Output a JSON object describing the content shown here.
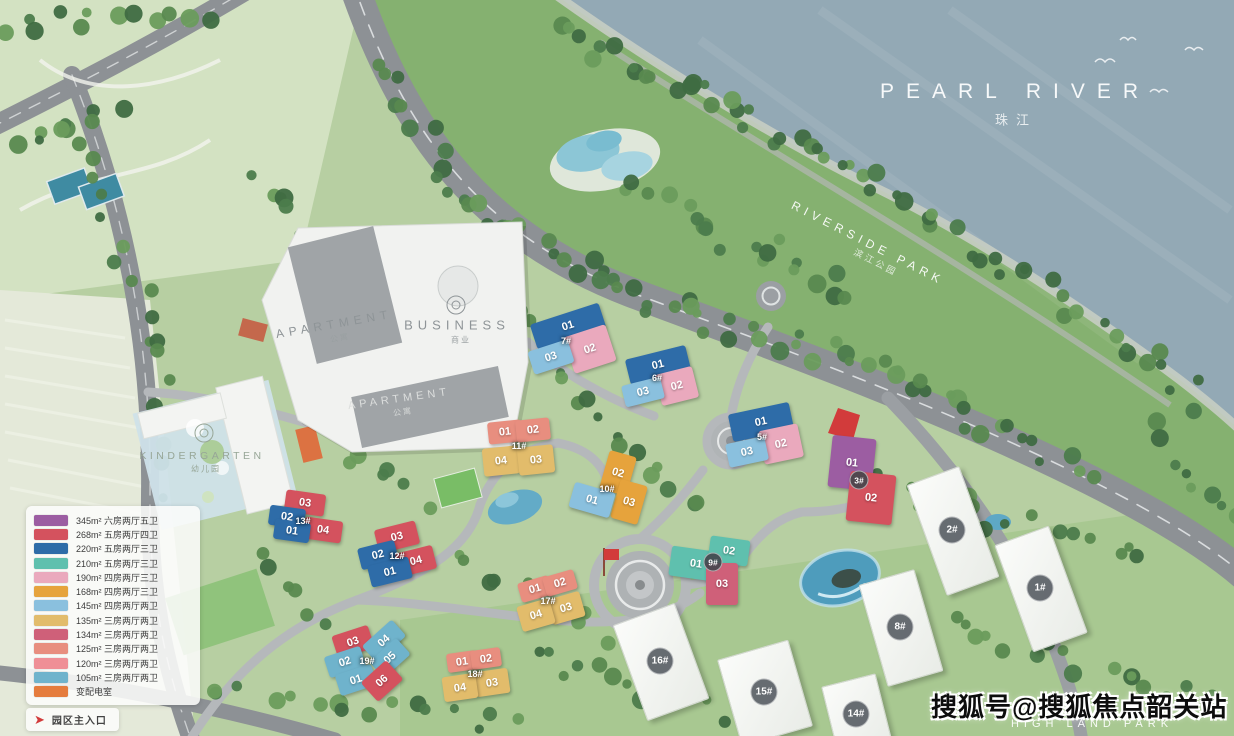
{
  "watermark": "搜狐号@搜狐焦点韶关站",
  "labels": {
    "river_en": "PEARL RIVER",
    "river_zh": "珠江",
    "riverside_en": "RIVERSIDE PARK",
    "riverside_zh": "滨江公园",
    "highland_en": "HIGH LAND PARK",
    "apartment_upper_en": "APARTMENT",
    "apartment_upper_zh": "公寓",
    "business_en": "BUSINESS",
    "business_zh": "商业",
    "apartment_lower_en": "APARTMENT",
    "apartment_lower_zh": "公寓",
    "kindergarten_en": "KINDERGARTEN",
    "kindergarten_zh": "幼儿园"
  },
  "legend": {
    "rows": [
      {
        "color": "#9c5da2",
        "area": "345m²",
        "desc": "六房两厅五卫"
      },
      {
        "color": "#d4525e",
        "area": "268m²",
        "desc": "五房两厅四卫"
      },
      {
        "color": "#2e6ca8",
        "area": "220m²",
        "desc": "五房两厅三卫"
      },
      {
        "color": "#5fc0ae",
        "area": "210m²",
        "desc": "五房两厅三卫"
      },
      {
        "color": "#eaa9bd",
        "area": "190m²",
        "desc": "四房两厅三卫"
      },
      {
        "color": "#e6a33c",
        "area": "168m²",
        "desc": "四房两厅三卫"
      },
      {
        "color": "#8ac0de",
        "area": "145m²",
        "desc": "四房两厅两卫"
      },
      {
        "color": "#e2bc6b",
        "area": "135m²",
        "desc": "三房两厅两卫"
      },
      {
        "color": "#cf6079",
        "area": "134m²",
        "desc": "三房两厅两卫"
      },
      {
        "color": "#e88e7f",
        "area": "125m²",
        "desc": "三房两厅两卫"
      },
      {
        "color": "#ef8f96",
        "area": "120m²",
        "desc": "三房两厅两卫"
      },
      {
        "color": "#6fb3cc",
        "area": "105m²",
        "desc": "三房两厅两卫"
      },
      {
        "color": "#e57c3d",
        "area": "",
        "desc": "变配电室"
      }
    ],
    "entrance_label": "园区主入口"
  },
  "buildings": [
    {
      "id": "7#",
      "x": 566,
      "y": 341,
      "badge": false,
      "units": [
        {
          "label": "01",
          "color": "#2e6ca8",
          "x": 568,
          "y": 326,
          "w": 72,
          "h": 26,
          "rot": -18
        },
        {
          "label": "02",
          "color": "#eaa9bd",
          "x": 590,
          "y": 349,
          "w": 44,
          "h": 38,
          "rot": -18
        },
        {
          "label": "03",
          "color": "#8ac0de",
          "x": 551,
          "y": 357,
          "w": 42,
          "h": 24,
          "rot": -18
        }
      ]
    },
    {
      "id": "6#",
      "x": 657,
      "y": 378,
      "badge": false,
      "units": [
        {
          "label": "01",
          "color": "#2e6ca8",
          "x": 658,
          "y": 365,
          "w": 62,
          "h": 26,
          "rot": -14
        },
        {
          "label": "02",
          "color": "#eaa9bd",
          "x": 677,
          "y": 386,
          "w": 38,
          "h": 32,
          "rot": -14
        },
        {
          "label": "03",
          "color": "#8ac0de",
          "x": 643,
          "y": 392,
          "w": 40,
          "h": 22,
          "rot": -14
        }
      ]
    },
    {
      "id": "5#",
      "x": 762,
      "y": 437,
      "badge": false,
      "units": [
        {
          "label": "01",
          "color": "#2e6ca8",
          "x": 761,
          "y": 422,
          "w": 62,
          "h": 28,
          "rot": -12
        },
        {
          "label": "02",
          "color": "#eaa9bd",
          "x": 781,
          "y": 444,
          "w": 40,
          "h": 34,
          "rot": -12
        },
        {
          "label": "03",
          "color": "#8ac0de",
          "x": 747,
          "y": 452,
          "w": 40,
          "h": 24,
          "rot": -12
        }
      ]
    },
    {
      "id": "3#",
      "x": 859,
      "y": 480,
      "badge": true,
      "units": [
        {
          "label": "01",
          "color": "#9c5da2",
          "x": 852,
          "y": 463,
          "w": 44,
          "h": 52,
          "rot": 6
        },
        {
          "label": "02",
          "color": "#d4525e",
          "x": 871,
          "y": 498,
          "w": 46,
          "h": 50,
          "rot": 6
        }
      ]
    },
    {
      "id": "9#",
      "x": 713,
      "y": 562,
      "badge": true,
      "units": [
        {
          "label": "01",
          "color": "#5fc0ae",
          "x": 696,
          "y": 564,
          "w": 52,
          "h": 30,
          "rot": 8
        },
        {
          "label": "02",
          "color": "#5fc0ae",
          "x": 729,
          "y": 551,
          "w": 40,
          "h": 26,
          "rot": 8
        },
        {
          "label": "03",
          "color": "#cf6079",
          "x": 722,
          "y": 584,
          "w": 32,
          "h": 42,
          "rot": 0
        }
      ]
    },
    {
      "id": "10#",
      "x": 607,
      "y": 489,
      "badge": false,
      "units": [
        {
          "label": "02",
          "color": "#e6a33c",
          "x": 618,
          "y": 473,
          "w": 28,
          "h": 40,
          "rot": 16
        },
        {
          "label": "03",
          "color": "#e6a33c",
          "x": 629,
          "y": 502,
          "w": 28,
          "h": 40,
          "rot": 16
        },
        {
          "label": "01",
          "color": "#8ac0de",
          "x": 592,
          "y": 500,
          "w": 42,
          "h": 26,
          "rot": 16
        }
      ]
    },
    {
      "id": "11#",
      "x": 519,
      "y": 446,
      "badge": false,
      "units": [
        {
          "label": "01",
          "color": "#e88e7f",
          "x": 505,
          "y": 432,
          "w": 34,
          "h": 22,
          "rot": -6
        },
        {
          "label": "02",
          "color": "#e88e7f",
          "x": 533,
          "y": 430,
          "w": 34,
          "h": 22,
          "rot": -6
        },
        {
          "label": "04",
          "color": "#e2bc6b",
          "x": 501,
          "y": 461,
          "w": 36,
          "h": 28,
          "rot": -6
        },
        {
          "label": "03",
          "color": "#e2bc6b",
          "x": 536,
          "y": 460,
          "w": 36,
          "h": 28,
          "rot": -6
        }
      ]
    },
    {
      "id": "12#",
      "x": 397,
      "y": 556,
      "badge": false,
      "units": [
        {
          "label": "03",
          "color": "#d4525e",
          "x": 397,
          "y": 537,
          "w": 42,
          "h": 24,
          "rot": -14
        },
        {
          "label": "02",
          "color": "#2e6ca8",
          "x": 378,
          "y": 555,
          "w": 38,
          "h": 22,
          "rot": -14
        },
        {
          "label": "04",
          "color": "#d4525e",
          "x": 416,
          "y": 561,
          "w": 38,
          "h": 24,
          "rot": -14
        },
        {
          "label": "01",
          "color": "#2e6ca8",
          "x": 390,
          "y": 572,
          "w": 42,
          "h": 22,
          "rot": -14
        }
      ]
    },
    {
      "id": "13#",
      "x": 303,
      "y": 521,
      "badge": false,
      "units": [
        {
          "label": "03",
          "color": "#d4525e",
          "x": 305,
          "y": 503,
          "w": 40,
          "h": 22,
          "rot": 8
        },
        {
          "label": "02",
          "color": "#2e6ca8",
          "x": 287,
          "y": 517,
          "w": 36,
          "h": 20,
          "rot": 8
        },
        {
          "label": "04",
          "color": "#d4525e",
          "x": 323,
          "y": 530,
          "w": 38,
          "h": 22,
          "rot": 8
        },
        {
          "label": "01",
          "color": "#2e6ca8",
          "x": 292,
          "y": 531,
          "w": 36,
          "h": 20,
          "rot": 8
        }
      ]
    },
    {
      "id": "17#",
      "x": 548,
      "y": 601,
      "badge": false,
      "units": [
        {
          "label": "01",
          "color": "#e88e7f",
          "x": 535,
          "y": 589,
          "w": 32,
          "h": 20,
          "rot": -16
        },
        {
          "label": "02",
          "color": "#e88e7f",
          "x": 560,
          "y": 583,
          "w": 32,
          "h": 20,
          "rot": -16
        },
        {
          "label": "03",
          "color": "#e2bc6b",
          "x": 566,
          "y": 608,
          "w": 34,
          "h": 26,
          "rot": -16
        },
        {
          "label": "04",
          "color": "#e2bc6b",
          "x": 536,
          "y": 615,
          "w": 34,
          "h": 26,
          "rot": -16
        }
      ]
    },
    {
      "id": "18#",
      "x": 475,
      "y": 674,
      "badge": false,
      "units": [
        {
          "label": "01",
          "color": "#e88e7f",
          "x": 462,
          "y": 661,
          "w": 30,
          "h": 19,
          "rot": -8
        },
        {
          "label": "02",
          "color": "#e88e7f",
          "x": 486,
          "y": 658,
          "w": 30,
          "h": 19,
          "rot": -8
        },
        {
          "label": "03",
          "color": "#e2bc6b",
          "x": 492,
          "y": 682,
          "w": 34,
          "h": 25,
          "rot": -8
        },
        {
          "label": "04",
          "color": "#e2bc6b",
          "x": 460,
          "y": 687,
          "w": 34,
          "h": 25,
          "rot": -8
        }
      ]
    },
    {
      "id": "19#",
      "x": 367,
      "y": 661,
      "badge": false,
      "units": [
        {
          "label": "03",
          "color": "#d4525e",
          "x": 353,
          "y": 642,
          "w": 38,
          "h": 24,
          "rot": -18
        },
        {
          "label": "04",
          "color": "#6fb3cc",
          "x": 384,
          "y": 641,
          "w": 40,
          "h": 22,
          "rot": -42
        },
        {
          "label": "05",
          "color": "#6fb3cc",
          "x": 390,
          "y": 658,
          "w": 36,
          "h": 22,
          "rot": -42
        },
        {
          "label": "02",
          "color": "#6fb3cc",
          "x": 345,
          "y": 662,
          "w": 38,
          "h": 22,
          "rot": -18
        },
        {
          "label": "01",
          "color": "#6fb3cc",
          "x": 356,
          "y": 680,
          "w": 38,
          "h": 22,
          "rot": -18
        },
        {
          "label": "06",
          "color": "#d4525e",
          "x": 382,
          "y": 681,
          "w": 34,
          "h": 26,
          "rot": -42
        }
      ]
    }
  ],
  "towers": [
    {
      "id": "1#",
      "x": 1040,
      "y": 588,
      "w": 56,
      "h": 112,
      "rot": -20
    },
    {
      "id": "2#",
      "x": 952,
      "y": 530,
      "w": 54,
      "h": 116,
      "rot": -20
    },
    {
      "id": "8#",
      "x": 900,
      "y": 627,
      "w": 56,
      "h": 104,
      "rot": -16
    },
    {
      "id": "14#",
      "x": 856,
      "y": 714,
      "w": 54,
      "h": 70,
      "rot": -14
    },
    {
      "id": "15#",
      "x": 764,
      "y": 692,
      "w": 72,
      "h": 88,
      "rot": -16
    },
    {
      "id": "16#",
      "x": 660,
      "y": 661,
      "w": 64,
      "h": 100,
      "rot": -20
    }
  ]
}
